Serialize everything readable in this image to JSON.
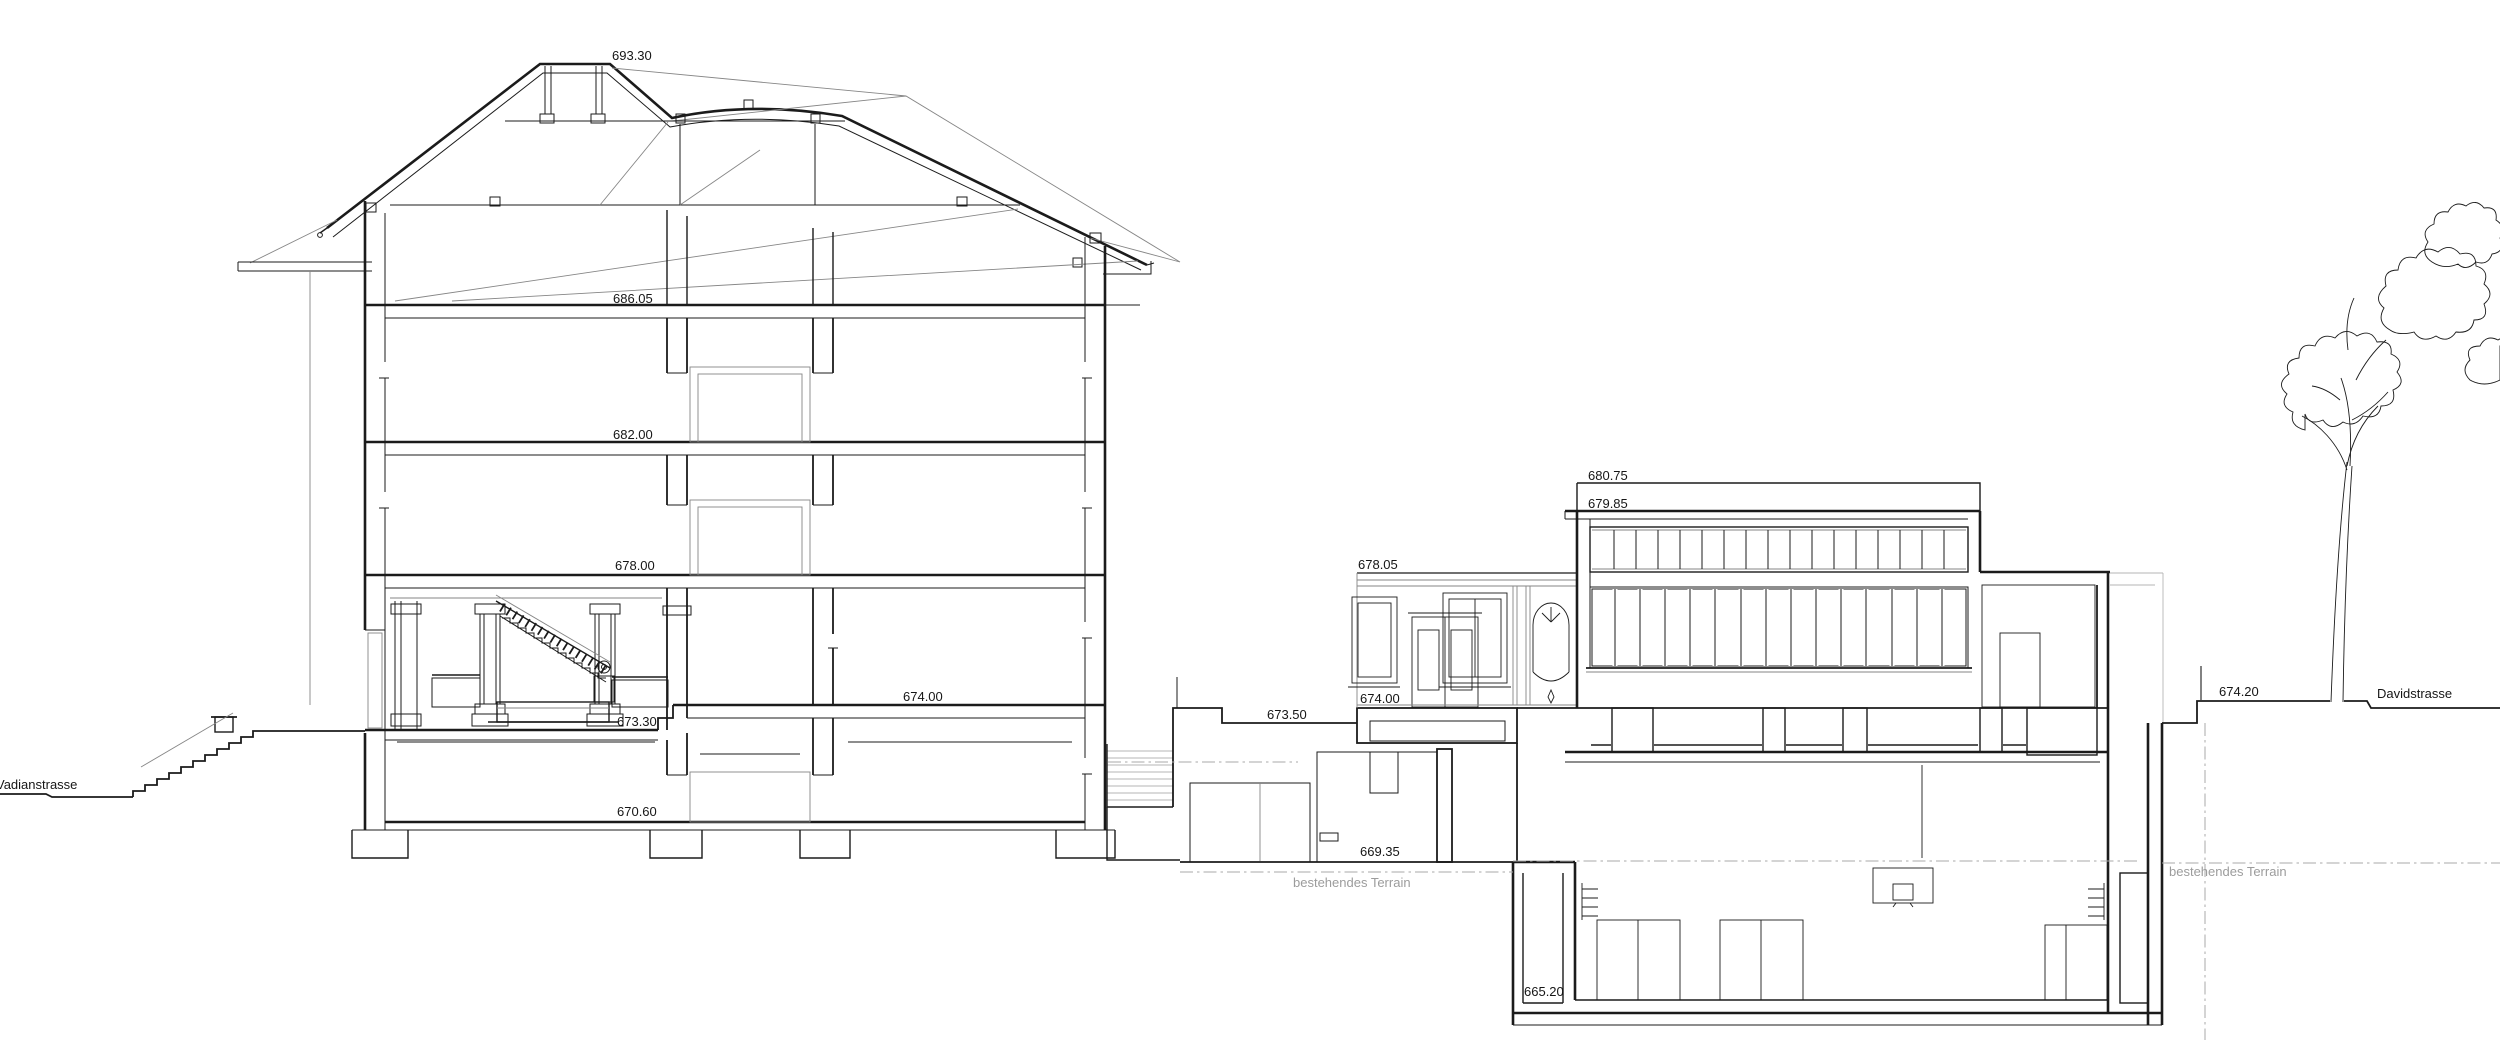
{
  "drawing": {
    "type": "architectural-section",
    "colors": {
      "ink": "#1b1b1b",
      "light_line": "#868686",
      "terrain_gray": "#9c9c9c",
      "background": "#ffffff"
    },
    "streets": {
      "left": "Vadianstrasse",
      "right": "Davidstrasse"
    },
    "notes": {
      "terrain_left": "bestehendes Terrain",
      "terrain_right": "bestehendes Terrain"
    },
    "levels": {
      "ridge": "693.30",
      "attic_floor": "686.05",
      "third_floor": "682.00",
      "second_floor": "678.00",
      "first_floor": "674.00",
      "entrance_hall": "673.30",
      "basement": "670.60",
      "annex_top": "678.05",
      "annex_floor": "674.00",
      "courtyard": "673.50",
      "lower_court": "669.35",
      "hall_parapet": "680.75",
      "hall_roof": "679.85",
      "hall_foundation": "665.20",
      "street_level_right": "674.20"
    }
  }
}
